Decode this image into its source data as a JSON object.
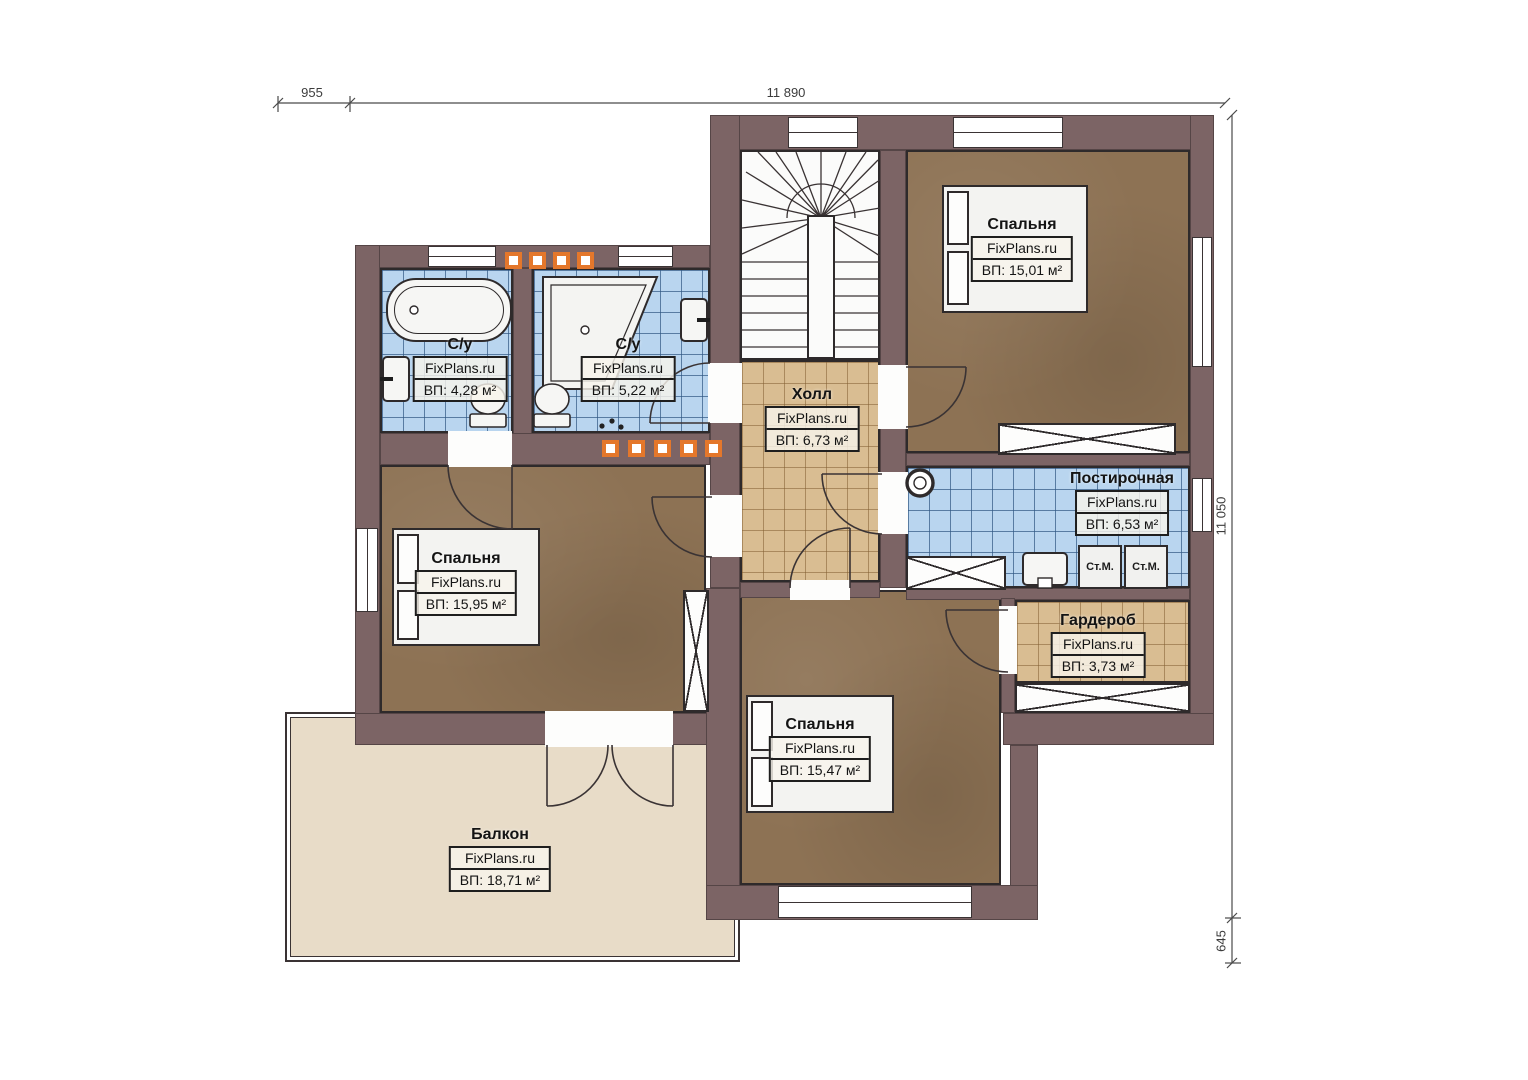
{
  "plan": {
    "watermark": "FixPlans.ru",
    "rooms": [
      {
        "key": "bathroom-1",
        "name": "С/у",
        "area": "ВП: 4,28 м²"
      },
      {
        "key": "bathroom-2",
        "name": "С/у",
        "area": "ВП: 5,22 м²"
      },
      {
        "key": "hall",
        "name": "Холл",
        "area": "ВП: 6,73 м²"
      },
      {
        "key": "bedroom-top",
        "name": "Спальня",
        "area": "ВП: 15,01 м²"
      },
      {
        "key": "laundry",
        "name": "Постирочная",
        "area": "ВП: 6,53 м²"
      },
      {
        "key": "bedroom-left",
        "name": "Спальня",
        "area": "ВП: 15,95 м²"
      },
      {
        "key": "wardrobe",
        "name": "Гардероб",
        "area": "ВП: 3,73 м²"
      },
      {
        "key": "bedroom-bottom",
        "name": "Спальня",
        "area": "ВП: 15,47 м²"
      },
      {
        "key": "balcony",
        "name": "Балкон",
        "area": "ВП: 18,71 м²"
      }
    ],
    "appliances": {
      "washer_left": "Ст.М.",
      "washer_right": "Ст.М."
    },
    "dimensions": {
      "top_offset": "955",
      "top_width": "11 890",
      "right_height": "11 050",
      "right_offset": "645"
    },
    "colors": {
      "wall": "#7c6465",
      "bedroom_floor": "#8d7254",
      "tile_blue": "#b9d5ef",
      "tile_tan": "#d9bd92",
      "balcony": "#e8dcc8",
      "accent_orange": "#e4772b"
    }
  }
}
